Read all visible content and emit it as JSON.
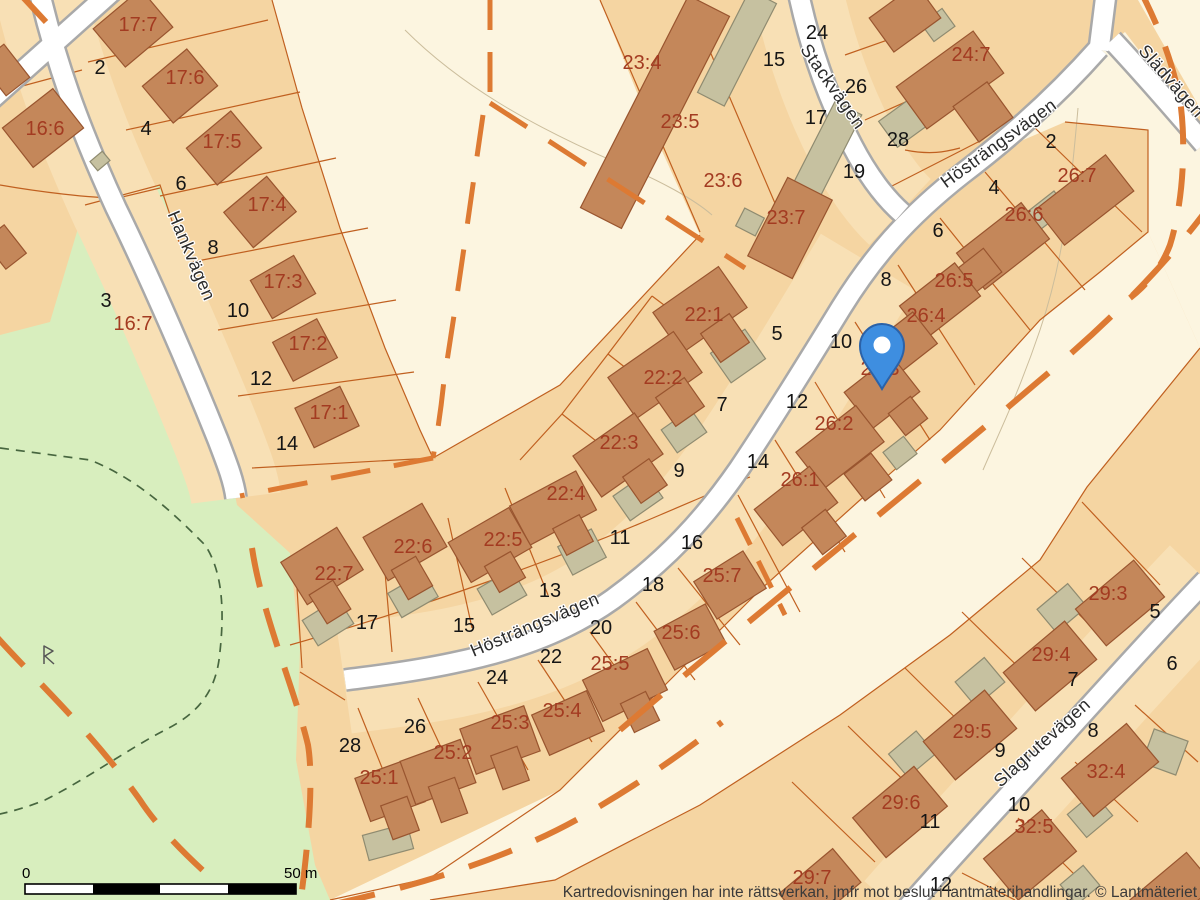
{
  "map": {
    "attribution": "Kartredovisningen har inte rättsverkan, jmfr mot beslut i lantmäterihandlingar. © Lantmäteriet",
    "scale_bar": {
      "zero_label": "0",
      "end_label": "50 m"
    },
    "marker": {
      "name": "location-pin",
      "x": 882,
      "y": 389,
      "color": "#3e8ee0"
    },
    "colors": {
      "parcel_fill": "#f5d5a2",
      "parcel_front_fill": "#f8e0b5",
      "open_land_fill": "#fcf5e0",
      "green_fill": "#d8eebe",
      "building_fill": "#c4875a",
      "building_stroke": "#99552f",
      "shed_fill": "#c6c1a0",
      "shed_stroke": "#8f8b70",
      "parcel_line": "#c06020",
      "boundary_dash": "#dd7a33",
      "road_fill": "#ffffff",
      "road_casing": "#a9a9a9",
      "parcel_label": "#a33b21",
      "house_number": "#151515",
      "path_dash_green": "#47663f"
    },
    "street_labels": [
      {
        "text": "Hankvägen",
        "x": 186,
        "y": 258,
        "rotate": 67
      },
      {
        "text": "Stackvägen",
        "x": 828,
        "y": 90,
        "rotate": 55
      },
      {
        "text": "Hösträngsvägen",
        "x": 1002,
        "y": 148,
        "rotate": -36
      },
      {
        "text": "Hösträngsvägen",
        "x": 537,
        "y": 630,
        "rotate": -23
      },
      {
        "text": "Slädvägen",
        "x": 1167,
        "y": 85,
        "rotate": 49
      },
      {
        "text": "Slagrutevägen",
        "x": 1046,
        "y": 747,
        "rotate": -42
      }
    ],
    "parcel_labels": [
      {
        "text": "17:7",
        "x": 138,
        "y": 31
      },
      {
        "text": "17:6",
        "x": 185,
        "y": 84
      },
      {
        "text": "16:6",
        "x": 45,
        "y": 135
      },
      {
        "text": "17:5",
        "x": 222,
        "y": 148
      },
      {
        "text": "17:4",
        "x": 267,
        "y": 211
      },
      {
        "text": "17:3",
        "x": 283,
        "y": 288
      },
      {
        "text": "17:2",
        "x": 308,
        "y": 350
      },
      {
        "text": "17:1",
        "x": 329,
        "y": 419
      },
      {
        "text": "16:7",
        "x": 133,
        "y": 330
      },
      {
        "text": "23:4",
        "x": 642,
        "y": 69
      },
      {
        "text": "23:5",
        "x": 680,
        "y": 128
      },
      {
        "text": "23:6",
        "x": 723,
        "y": 187
      },
      {
        "text": "23:7",
        "x": 786,
        "y": 224
      },
      {
        "text": "24:7",
        "x": 971,
        "y": 61
      },
      {
        "text": "26:7",
        "x": 1077,
        "y": 182
      },
      {
        "text": "26:6",
        "x": 1024,
        "y": 221
      },
      {
        "text": "26:5",
        "x": 954,
        "y": 287
      },
      {
        "text": "26:4",
        "x": 926,
        "y": 322
      },
      {
        "text": "26:3",
        "x": 880,
        "y": 375
      },
      {
        "text": "26:2",
        "x": 834,
        "y": 430
      },
      {
        "text": "26:1",
        "x": 800,
        "y": 486
      },
      {
        "text": "22:1",
        "x": 704,
        "y": 321
      },
      {
        "text": "22:2",
        "x": 663,
        "y": 384
      },
      {
        "text": "22:3",
        "x": 619,
        "y": 449
      },
      {
        "text": "22:4",
        "x": 566,
        "y": 500
      },
      {
        "text": "22:5",
        "x": 503,
        "y": 546
      },
      {
        "text": "22:6",
        "x": 413,
        "y": 553
      },
      {
        "text": "22:7",
        "x": 334,
        "y": 580
      },
      {
        "text": "25:7",
        "x": 722,
        "y": 582
      },
      {
        "text": "25:6",
        "x": 681,
        "y": 639
      },
      {
        "text": "25:5",
        "x": 610,
        "y": 670
      },
      {
        "text": "25:4",
        "x": 562,
        "y": 717
      },
      {
        "text": "25:3",
        "x": 510,
        "y": 729
      },
      {
        "text": "25:2",
        "x": 453,
        "y": 759
      },
      {
        "text": "25:1",
        "x": 379,
        "y": 784
      },
      {
        "text": "29:3",
        "x": 1108,
        "y": 600
      },
      {
        "text": "29:4",
        "x": 1051,
        "y": 661
      },
      {
        "text": "29:5",
        "x": 972,
        "y": 738
      },
      {
        "text": "29:6",
        "x": 901,
        "y": 809
      },
      {
        "text": "29:7",
        "x": 812,
        "y": 884
      },
      {
        "text": "32:4",
        "x": 1106,
        "y": 778
      },
      {
        "text": "32:5",
        "x": 1034,
        "y": 833
      }
    ],
    "house_numbers": [
      {
        "text": "2",
        "x": 100,
        "y": 74
      },
      {
        "text": "4",
        "x": 146,
        "y": 135
      },
      {
        "text": "6",
        "x": 181,
        "y": 190
      },
      {
        "text": "8",
        "x": 213,
        "y": 254
      },
      {
        "text": "10",
        "x": 238,
        "y": 317
      },
      {
        "text": "12",
        "x": 261,
        "y": 385
      },
      {
        "text": "14",
        "x": 287,
        "y": 450
      },
      {
        "text": "3",
        "x": 106,
        "y": 307
      },
      {
        "text": "24",
        "x": 817,
        "y": 39
      },
      {
        "text": "15",
        "x": 774,
        "y": 66
      },
      {
        "text": "26",
        "x": 856,
        "y": 93
      },
      {
        "text": "17",
        "x": 816,
        "y": 124
      },
      {
        "text": "28",
        "x": 898,
        "y": 146
      },
      {
        "text": "19",
        "x": 854,
        "y": 178
      },
      {
        "text": "2",
        "x": 1051,
        "y": 148
      },
      {
        "text": "4",
        "x": 994,
        "y": 194
      },
      {
        "text": "6",
        "x": 938,
        "y": 237
      },
      {
        "text": "8",
        "x": 886,
        "y": 286
      },
      {
        "text": "10",
        "x": 841,
        "y": 348
      },
      {
        "text": "12",
        "x": 797,
        "y": 408
      },
      {
        "text": "14",
        "x": 758,
        "y": 468
      },
      {
        "text": "5",
        "x": 777,
        "y": 340
      },
      {
        "text": "7",
        "x": 722,
        "y": 411
      },
      {
        "text": "9",
        "x": 679,
        "y": 477
      },
      {
        "text": "11",
        "x": 620,
        "y": 544
      },
      {
        "text": "13",
        "x": 550,
        "y": 597
      },
      {
        "text": "15",
        "x": 464,
        "y": 632
      },
      {
        "text": "17",
        "x": 367,
        "y": 629
      },
      {
        "text": "16",
        "x": 692,
        "y": 549
      },
      {
        "text": "18",
        "x": 653,
        "y": 591
      },
      {
        "text": "20",
        "x": 601,
        "y": 634
      },
      {
        "text": "22",
        "x": 551,
        "y": 663
      },
      {
        "text": "24",
        "x": 497,
        "y": 684
      },
      {
        "text": "26",
        "x": 415,
        "y": 733
      },
      {
        "text": "28",
        "x": 350,
        "y": 752
      },
      {
        "text": "5",
        "x": 1155,
        "y": 618
      },
      {
        "text": "6",
        "x": 1172,
        "y": 670
      },
      {
        "text": "7",
        "x": 1073,
        "y": 686
      },
      {
        "text": "8",
        "x": 1093,
        "y": 737
      },
      {
        "text": "9",
        "x": 1000,
        "y": 757
      },
      {
        "text": "10",
        "x": 1019,
        "y": 811
      },
      {
        "text": "11",
        "x": 930,
        "y": 828
      },
      {
        "text": "12",
        "x": 941,
        "y": 891
      }
    ]
  }
}
